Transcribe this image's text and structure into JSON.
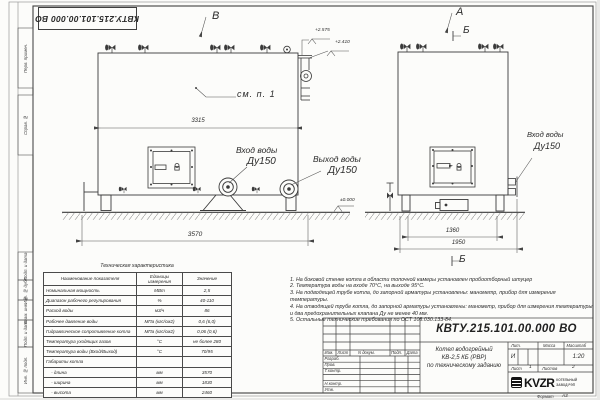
{
  "doc": {
    "number": "КВТУ.215.101.00.000 ВО",
    "format_label": "Формат",
    "format_value": "А3"
  },
  "margin_fields": [
    "Перв. примен.",
    "Справ. №",
    "Подп. и дата",
    "Инв. № дубл.",
    "Взам. инв. №",
    "Подп. и дата",
    "Инв. № подл."
  ],
  "views": {
    "front": {
      "label": "В",
      "see_note": "см. п. 1",
      "dim_length": "3315",
      "dim_total": "3570",
      "elev_top1": "+2.575",
      "elev_top2": "+2.410",
      "elev_zero": "±0.000",
      "inlet": "Вход воды",
      "inlet_dn": "Ду150",
      "outlet": "Выход воды",
      "outlet_dn": "Ду150"
    },
    "side": {
      "label_a": "А",
      "label_b": "Б",
      "dim_width": "1360",
      "dim_total": "1950",
      "inlet": "Вход воды",
      "inlet_dn": "Ду150"
    }
  },
  "spec_table": {
    "title": "Техническая характеристика",
    "headers": [
      "Наименование показателя",
      "Единицы измерения",
      "Значение"
    ],
    "rows": [
      [
        "Номинальная мощность",
        "МВт",
        "2,5"
      ],
      [
        "Диапазон рабочего регулирования",
        "%",
        "40-110"
      ],
      [
        "Расход воды",
        "м3/ч",
        "86"
      ],
      [
        "Рабочее давление воды",
        "МПа (кгс/см2)",
        "0,6 (6,0)"
      ],
      [
        "Гидравлическое сопротивление котла",
        "МПа (кгс/см2)",
        "0,06 (0,6)"
      ],
      [
        "Температура уходящих газов",
        "°С",
        "не более 280"
      ],
      [
        "Температура воды (Вход/Выход)",
        "°С",
        "70/95"
      ],
      [
        "Габариты котла",
        "",
        ""
      ],
      [
        "    - длина",
        "мм",
        "3570"
      ],
      [
        "    - ширина",
        "мм",
        "1830"
      ],
      [
        "    - высота",
        "мм",
        "2460"
      ]
    ]
  },
  "notes": [
    "1.  На боковой стенке котла в области топочной камеры установлен пробоотборный штуцер",
    "2.  Температура воды на входе 70°С, на выходе 95°С.",
    "3.  На подводящей трубе котла, до запорной арматуры установлены: манометр, прибор для измерения температуры.",
    "4.  На отводящей трубе котла, до запорной арматуры установлены: манометр, прибор для измерения температуры и два предохранительных клапана Ду не менее 40 мм.",
    "5.  Остальные технические требования по ОСТ 108.030.133-84."
  ],
  "title_block": {
    "col_headers": [
      "Изм.",
      "Лист",
      "N докум.",
      "Подп.",
      "Дата"
    ],
    "row_labels": [
      "Разраб.",
      "Пров.",
      "Т.контр.",
      "",
      "Н.контр.",
      "Утв."
    ],
    "item_name_lines": [
      "Котел водогрейный",
      "КВ-2,5 КБ (РВР)",
      "по техническому заданию"
    ],
    "lit_header": "Лит.",
    "lit_value": "И",
    "mass_header": "Масса",
    "scale_header": "Масштаб",
    "scale_value": "1:20",
    "sheet_label": "Лист",
    "sheet_value": "1",
    "sheets_label": "Листов",
    "sheets_value": "2",
    "logo_text": "KVZR",
    "logo_sub1": "КОТЕЛЬНЫЙ",
    "logo_sub2": "ЗАВОД РЭП"
  }
}
